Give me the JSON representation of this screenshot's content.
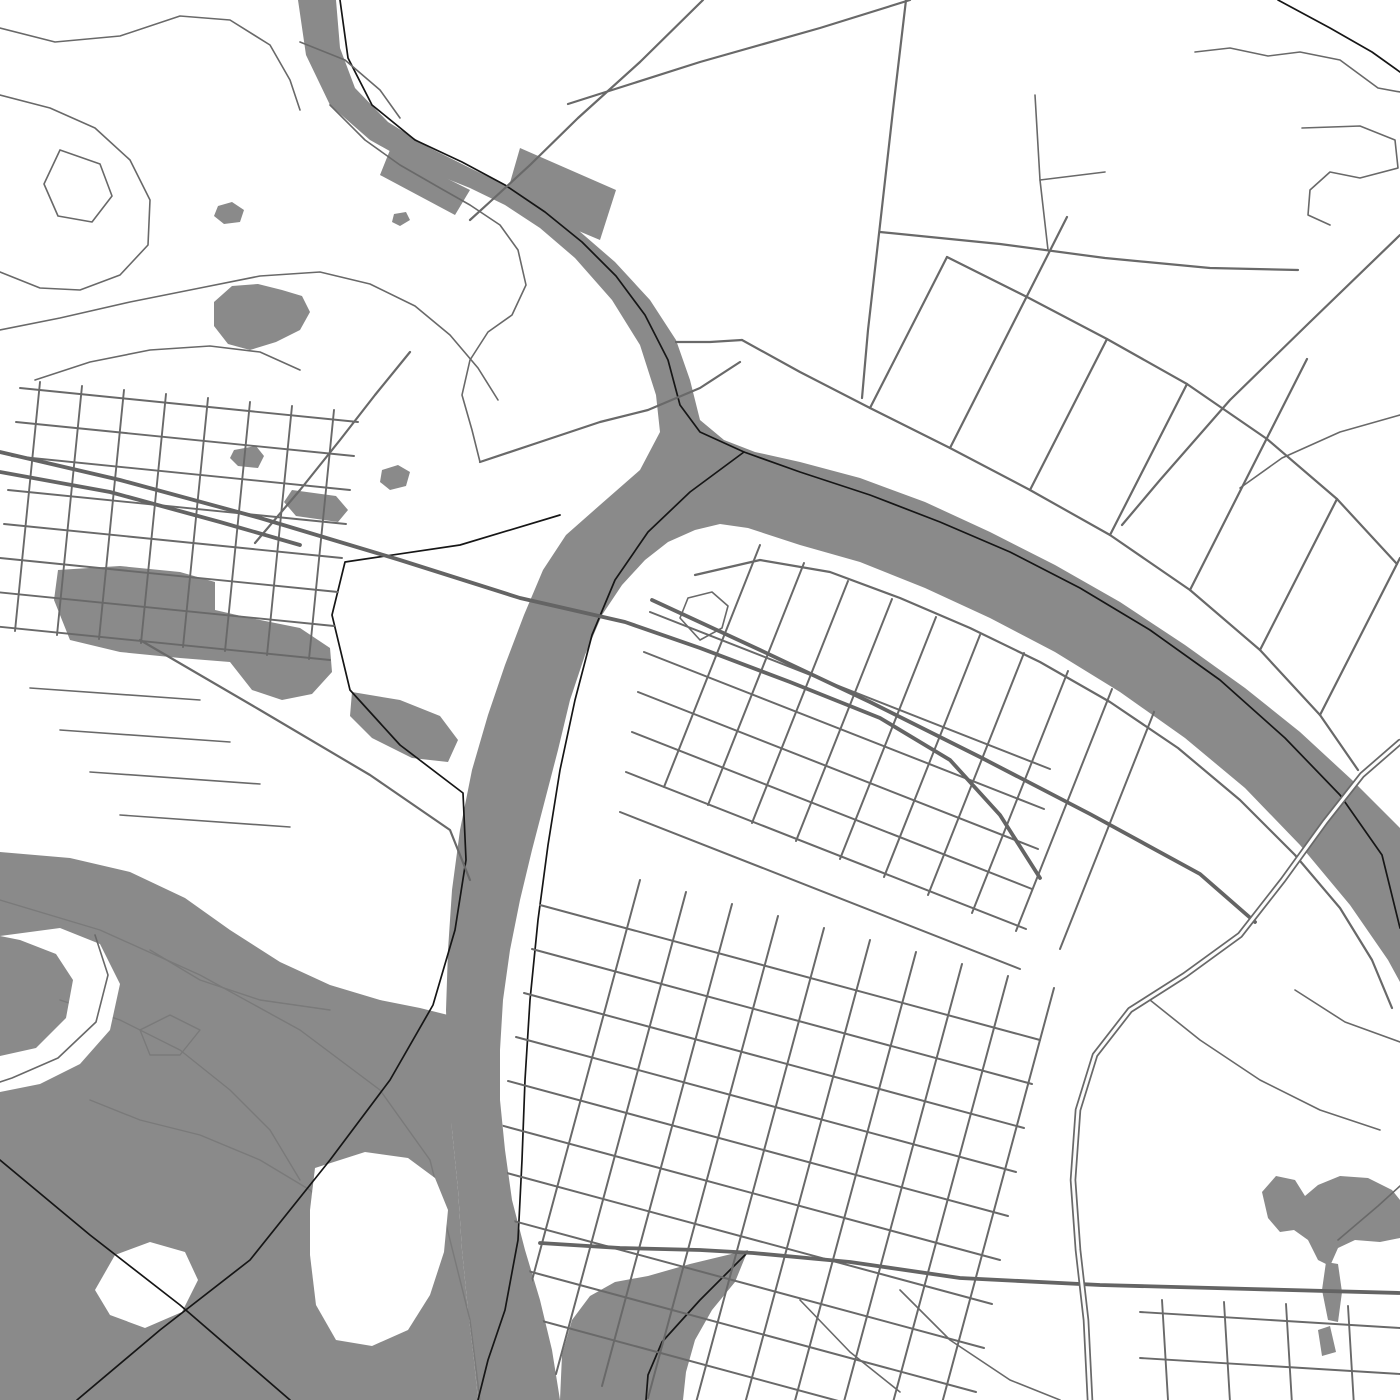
{
  "meta": {
    "kind": "city-street-map",
    "width": 1400,
    "height": 1400,
    "visible_text": []
  },
  "palette": {
    "land": "#ffffff",
    "water": "#8a8a8a",
    "stream": "#7a7a7a",
    "road": "#696969",
    "road_major": "#646464",
    "boundary": "#161616",
    "casing_core": "#fdfdfd"
  },
  "clips": [
    {
      "id": "east-land",
      "pts": "748,526 820,548 900,578 975,610 1050,646 1125,690 1195,740 1250,792 1305,848 1352,906 1390,962 1400,990 1400,1400 560,1400 548,1340 532,1280 515,1225 506,1165 501,1105 501,1045 506,985 514,935 524,885 536,835 550,785 562,735 575,690 590,648 608,612 628,585 648,562 668,545 692,533 718,526"
    },
    {
      "id": "west-land",
      "pts": "0,378 362,378 362,700 0,700"
    }
  ],
  "layers": [
    {
      "name": "water-layer",
      "kind": "polygons",
      "fill": "water",
      "items": [
        {
          "name": "river-system",
          "pts": "298,0 306,55 330,105 370,140 420,168 470,188 505,205 540,228 575,258 612,300 640,345 656,395 660,432 640,470 600,505 566,535 543,570 524,615 505,665 488,715 472,770 460,830 452,890 448,950 446,1010 448,1070 452,1130 458,1190 462,1250 468,1310 474,1360 478,1400 560,1400 552,1350 540,1300 525,1250 512,1200 505,1150 500,1100 500,1050 503,1000 510,950 520,900 532,850 545,800 558,750 570,700 585,655 602,615 622,585 645,560 668,542 695,530 720,524 748,528 800,545 860,562 925,588 990,618 1055,652 1120,692 1185,738 1245,788 1300,845 1350,905 1388,960 1400,982 1400,828 1352,780 1300,732 1245,688 1185,645 1120,602 1055,565 990,532 925,502 860,478 800,462 755,452 724,440 700,420 690,380 676,340 650,300 615,262 578,230 540,205 505,185 470,168 430,148 388,122 355,88 340,48 336,0"
        },
        {
          "name": "wetland",
          "pts": "0,852 70,858 130,872 185,898 230,930 280,962 330,985 380,1000 420,1008 448,1015 452,1130 458,1190 462,1250 468,1310 474,1360 478,1400 0,1400"
        },
        {
          "name": "tidal-creek",
          "pts": "748,1250 735,1282 712,1310 695,1340 686,1372 683,1400 560,1400 562,1355 572,1320 590,1296 615,1282 648,1276 690,1264"
        },
        {
          "name": "pond-southeast",
          "pts": "1268,1218 1262,1192 1276,1176 1295,1180 1305,1196 1318,1185 1340,1176 1368,1178 1392,1190 1400,1200 1400,1238 1380,1242 1355,1240 1338,1248 1330,1266 1318,1260 1308,1240 1294,1230 1280,1232"
        },
        {
          "name": "pond-neck",
          "pts": "1326,1262 1338,1264 1342,1292 1338,1322 1328,1320 1322,1290"
        },
        {
          "name": "pond-blob",
          "pts": "1318,1330 1330,1326 1336,1352 1322,1356"
        },
        {
          "name": "pond-a",
          "pts": "218,206 232,202 244,210 240,222 224,224 214,216"
        },
        {
          "name": "pond-b",
          "pts": "214,302 232,286 258,284 282,290 302,296 310,312 300,330 276,342 250,350 228,344 214,326"
        },
        {
          "name": "pond-c",
          "pts": "394,214 406,212 410,220 400,226 392,222"
        },
        {
          "name": "pond-d",
          "pts": "382,470 398,465 410,472 406,486 390,490 380,482"
        },
        {
          "name": "pond-e",
          "pts": "234,450 256,446 264,456 258,468 238,466 230,458"
        },
        {
          "name": "flats-west",
          "pts": "58,570 120,566 180,572 215,582 215,610 250,618 300,628 330,648 332,672 312,694 282,700 252,690 230,662 180,658 120,652 70,640 54,600"
        },
        {
          "name": "flats-g",
          "pts": "292,490 336,496 348,510 338,522 296,516 284,502"
        },
        {
          "name": "flats-h",
          "pts": "352,692 400,700 440,716 458,740 448,762 412,758 372,738 350,716"
        },
        {
          "name": "industrial-a",
          "pts": "520,148 616,190 600,240 505,200"
        },
        {
          "name": "industrial-b",
          "pts": "390,150 470,190 455,215 380,175"
        }
      ]
    },
    {
      "name": "stream-layer",
      "kind": "lines",
      "stroke": "stream",
      "width": 1.4,
      "items": [
        {
          "name": "marsh-channel-1",
          "pts": "60,1000 120,1020 180,1050 230,1090 270,1130 300,1180"
        },
        {
          "name": "marsh-channel-2",
          "pts": "150,950 200,980 260,1000 330,1010"
        },
        {
          "name": "marsh-channel-3",
          "pts": "90,1100 140,1120 200,1135 260,1160 310,1190 350,1230 380,1280"
        },
        {
          "name": "marsh-loop",
          "pts": "140,1030 170,1015 200,1030 180,1055 150,1055 140,1030"
        },
        {
          "name": "marsh-channel-4",
          "pts": "0,900 100,930 200,975 300,1030 380,1090 430,1160 450,1240 470,1320 480,1400"
        }
      ]
    },
    {
      "name": "island-layer",
      "kind": "polygons",
      "fill": "land",
      "items": [
        {
          "name": "island-a",
          "pts": "95,1290 115,1255 150,1242 185,1252 198,1280 182,1312 145,1328 110,1315"
        },
        {
          "name": "island-b",
          "pts": "315,1168 365,1152 408,1158 435,1178 448,1210 444,1252 430,1295 408,1330 372,1346 336,1340 316,1305 310,1255 310,1210"
        },
        {
          "name": "levee-corridor",
          "pts": "60,928 100,944 120,984 110,1030 80,1064 40,1084 0,1092 0,1056 36,1048 66,1018 73,980 56,954 20,940 0,936"
        }
      ]
    },
    {
      "name": "boundary-layer",
      "kind": "lines",
      "stroke": "boundary",
      "width": 1.7,
      "items": [
        {
          "name": "boundary-main-river",
          "pts": "340,0 348,58 372,105 415,140 462,162 505,185 545,212 582,242 616,276 645,315 668,360 680,405 700,432 744,452 800,472 870,495 940,522 1010,552 1080,588 1150,630 1220,680 1285,738 1340,795 1382,855 1400,928"
        },
        {
          "name": "boundary-south-branch",
          "pts": "744,452 690,492 648,532 615,580 592,635 575,700 560,770 548,845 538,920 530,1000 525,1080 522,1160 518,1240 505,1310 488,1360 478,1400"
        },
        {
          "name": "boundary-overland-west",
          "pts": "560,515 460,545 345,562 332,615 350,690 400,745 463,793 466,860 455,930 433,1005 390,1080 330,1160 250,1260 160,1330 77,1400"
        },
        {
          "name": "boundary-wetland-south",
          "pts": "0,1160 90,1235 180,1305 290,1400"
        },
        {
          "name": "boundary-corner-arc",
          "pts": "1278,0 1330,28 1372,52 1400,72"
        },
        {
          "name": "boundary-creek",
          "pts": "748,1252 700,1300 662,1342 648,1375 646,1400"
        }
      ]
    },
    {
      "name": "road-minor-layer",
      "kind": "lines",
      "stroke": "road",
      "width": 1.6,
      "items": [
        {
          "name": "lane-nw-1",
          "pts": "0,28 55,42 120,36 180,16 230,20 270,45 290,80 300,110"
        },
        {
          "name": "lane-nw-2",
          "pts": "0,95 50,108 95,128 130,160 150,200 148,245 120,275 80,290 40,288 0,272"
        },
        {
          "name": "lane-nw-loop",
          "pts": "60,150 100,164 112,196 92,222 58,216 44,184 60,150"
        },
        {
          "name": "lane-nw-3",
          "pts": "0,330 60,318 130,302 200,288 260,276 320,272 370,284 415,306 450,335 478,368 498,400"
        },
        {
          "name": "lane-nw-4",
          "pts": "35,380 90,362 150,350 210,346 260,352 300,370"
        },
        {
          "name": "lane-riverbank-n",
          "pts": "300,42 345,60 380,90 400,118"
        },
        {
          "name": "lane-riverbank-w",
          "pts": "330,105 365,140 400,165 440,188 470,205 500,225 518,250 526,285 512,315 488,332 470,360 462,395 472,430 480,462"
        },
        {
          "name": "lane-west-stub-1",
          "pts": "30,688 200,700"
        },
        {
          "name": "lane-west-stub-2",
          "pts": "60,730 230,742"
        },
        {
          "name": "lane-west-stub-3",
          "pts": "90,772 260,784"
        },
        {
          "name": "lane-west-stub-4",
          "pts": "120,815 290,827"
        },
        {
          "name": "levee-road",
          "pts": "95,935 108,975 96,1022 58,1058 12,1078 0,1082"
        },
        {
          "name": "rural-ne-1",
          "pts": "1195,52 1230,48 1268,56 1300,52 1340,60 1378,88 1400,92"
        },
        {
          "name": "rural-ne-hook",
          "pts": "1302,128 1360,126 1395,140 1398,168 1360,178 1330,172 1310,190 1308,215 1330,225"
        },
        {
          "name": "rural-ne-2",
          "pts": "1400,415 1340,432 1282,458 1240,488"
        },
        {
          "name": "rural-ne-3",
          "pts": "1035,95 1040,180 1048,250"
        },
        {
          "name": "rural-ne-3b",
          "pts": "1040,180 1105,172"
        },
        {
          "name": "se-shore-road",
          "pts": "1150,1000 1200,1040 1260,1080 1320,1110 1380,1130"
        },
        {
          "name": "se-curve-1",
          "pts": "900,1290 950,1340 1010,1380 1060,1400"
        },
        {
          "name": "se-curve-2",
          "pts": "800,1300 850,1352 900,1392"
        },
        {
          "name": "pond-causeway",
          "pts": "1338,1240 1378,1206 1400,1186"
        },
        {
          "name": "interchange-loop",
          "pts": "700,640 680,618 688,598 712,592 728,606 722,628 700,640"
        },
        {
          "name": "riverside-se-low",
          "pts": "1295,990 1345,1022 1400,1042"
        }
      ]
    },
    {
      "name": "grid-west-layer",
      "kind": "grids",
      "stroke": "road",
      "width": 1.9,
      "clip": "west-land",
      "families": [
        {
          "name": "west-streets-ew",
          "ox": 20,
          "oy": 388,
          "sx": -4,
          "sy": 34,
          "ex": 338,
          "ey": 34,
          "count": 8
        },
        {
          "name": "west-streets-ns",
          "ox": 40,
          "oy": 382,
          "sx": 42,
          "sy": 4,
          "ex": -25,
          "ey": 249,
          "count": 8
        }
      ]
    },
    {
      "name": "grid-peninsula-layer",
      "kind": "grids",
      "stroke": "road",
      "width": 2.0,
      "clip": "east-land",
      "families": [
        {
          "name": "peninsula-streets-ese",
          "ox": 650,
          "oy": 612,
          "sx": -6,
          "sy": 40,
          "ex": 400,
          "ey": 157,
          "count": 6
        },
        {
          "name": "peninsula-streets-ssw",
          "ox": 760,
          "oy": 545,
          "sx": 44,
          "sy": 18,
          "ex": -96,
          "ey": 242,
          "count": 10
        }
      ]
    },
    {
      "name": "grid-south-layer",
      "kind": "grids",
      "stroke": "road",
      "width": 2.0,
      "clip": "east-land",
      "families": [
        {
          "name": "south-streets-ese",
          "ox": 540,
          "oy": 905,
          "sx": -8,
          "sy": 44,
          "ex": 500,
          "ey": 135,
          "count": 10
        },
        {
          "name": "south-streets-ssw",
          "ox": 640,
          "oy": 880,
          "sx": 46,
          "sy": 12,
          "ex": -130,
          "ey": 482,
          "count": 10
        }
      ]
    },
    {
      "name": "grid-se-layer",
      "kind": "grids",
      "stroke": "road",
      "width": 1.9,
      "clip": "east-land",
      "families": [
        {
          "name": "se-streets-ew",
          "ox": 1140,
          "oy": 1312,
          "sx": 0,
          "sy": 46,
          "ex": 260,
          "ey": 16,
          "count": 2
        },
        {
          "name": "se-streets-ns",
          "ox": 1162,
          "oy": 1300,
          "sx": 62,
          "sy": 2,
          "ex": 6,
          "ey": 100,
          "count": 5
        }
      ]
    },
    {
      "name": "road-standard-layer",
      "kind": "lines",
      "stroke": "road",
      "width": 2.2,
      "items": [
        {
          "name": "rural-vertical",
          "pts": "906,0 893,110 880,225 868,330 862,398"
        },
        {
          "name": "rural-east-west",
          "pts": "880,232 1000,244 1105,258 1210,268 1298,270"
        },
        {
          "name": "diagonal-to-river",
          "pts": "703,0 640,62 578,118 530,165 492,200 470,220"
        },
        {
          "name": "top-straight",
          "pts": "568,104 700,62 820,28 910,0"
        },
        {
          "name": "upper-bridge-road",
          "pts": "480,462 540,442 600,422 648,410 700,388 740,362"
        },
        {
          "name": "bend-link",
          "pts": "676,342 710,342 742,340"
        },
        {
          "name": "riverside-south-bank",
          "pts": "695,575 760,560 830,572 900,598 970,628 1040,662 1110,702 1178,748 1240,800 1295,855 1340,908 1372,960 1392,1008"
        },
        {
          "name": "riverside-north-bank",
          "pts": "742,340 800,372 870,408 950,448 1030,490 1110,535 1190,590 1260,650 1320,715 1358,770"
        },
        {
          "name": "ne-parallel-road",
          "pts": "947,257 1027,297 1107,339 1187,384 1267,439 1337,499 1397,564"
        },
        {
          "name": "ne-comb-1",
          "pts": "870,408 947,257"
        },
        {
          "name": "ne-comb-2",
          "pts": "950,448 1067,217"
        },
        {
          "name": "ne-comb-3",
          "pts": "1030,490 1107,339"
        },
        {
          "name": "ne-comb-4",
          "pts": "1110,535 1187,384"
        },
        {
          "name": "ne-comb-5",
          "pts": "1190,590 1307,359"
        },
        {
          "name": "ne-comb-6",
          "pts": "1260,650 1337,499"
        },
        {
          "name": "ne-comb-7",
          "pts": "1320,715 1400,558"
        },
        {
          "name": "ne-diagonal-long",
          "pts": "1400,235 1310,322 1230,400 1160,480 1122,525"
        },
        {
          "name": "west-link-road",
          "pts": "140,640 260,710 370,775 450,830 470,880"
        },
        {
          "name": "west-connector-ne",
          "pts": "255,543 300,490 340,440 375,395 410,352"
        }
      ]
    },
    {
      "name": "road-major-layer",
      "kind": "lines",
      "stroke": "road_major",
      "width": 3.8,
      "items": [
        {
          "name": "artery-bridge-west",
          "pts": "0,452 120,480 260,518 400,560 520,598 625,622 700,648 790,682 880,718 950,760 1000,815 1040,878"
        },
        {
          "name": "artery-west-pair",
          "pts": "0,472 110,492 220,522 300,545"
        },
        {
          "name": "artery-south",
          "pts": "540,1243 620,1248 700,1250 753,1253 850,1262 960,1278 1100,1285 1250,1289 1400,1293"
        },
        {
          "name": "artery-peninsula",
          "pts": "652,600 760,650 870,702 980,757 1090,814 1200,874 1255,922"
        }
      ]
    },
    {
      "name": "highway-layer",
      "kind": "casing",
      "stroke": "road",
      "core": "casing_core",
      "outer": 6.5,
      "inner": 3.0,
      "items": [
        {
          "name": "highway-southeast-bridge",
          "pts": "1400,742 1362,775 1325,822 1283,880 1240,935 1185,975 1130,1010 1095,1055 1078,1110 1073,1180 1078,1250 1086,1320 1090,1400"
        }
      ]
    }
  ]
}
